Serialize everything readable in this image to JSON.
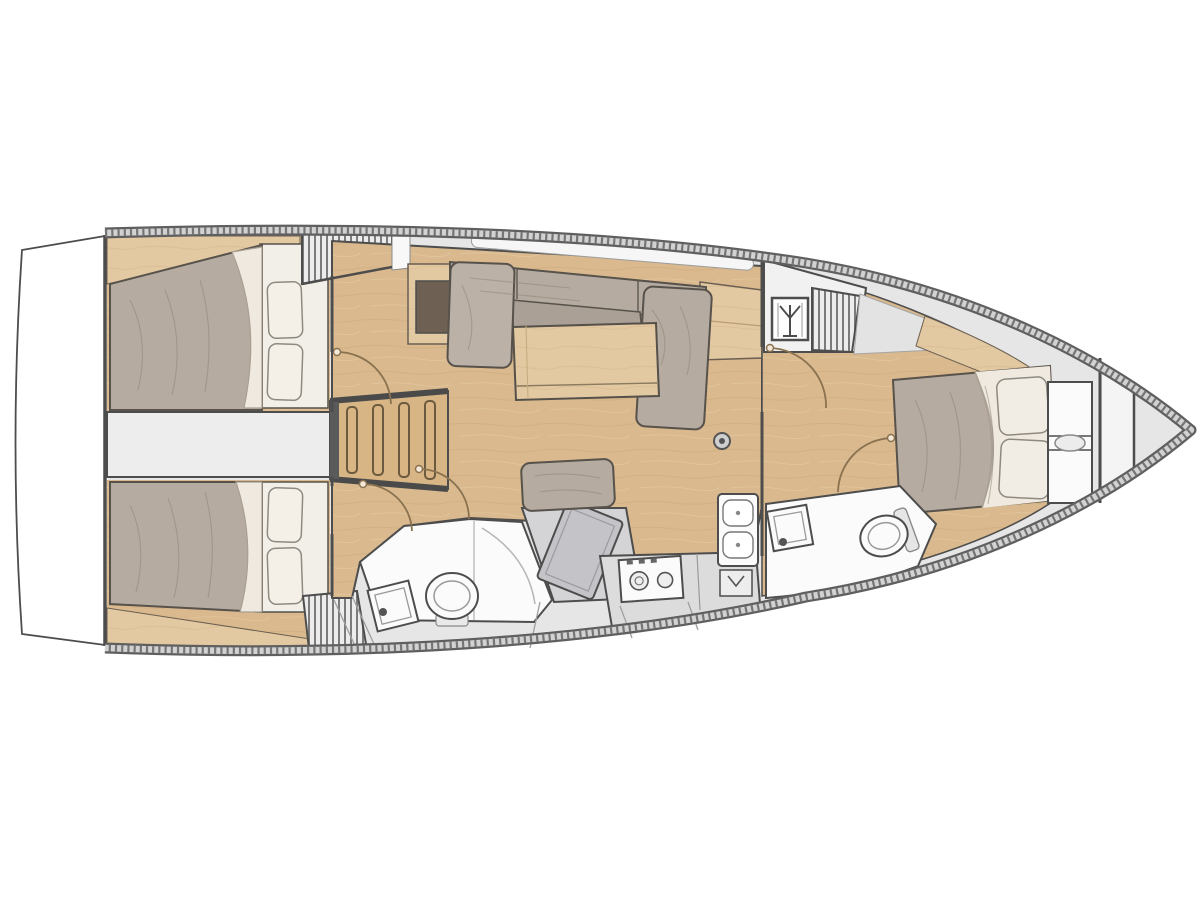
{
  "diagram": {
    "type": "sailing-yacht-interior-floor-plan",
    "orientation": {
      "bow": "right",
      "stern": "left"
    },
    "rooms": [
      {
        "id": "swim-platform",
        "name": "transom swim platform"
      },
      {
        "id": "aft-cabin-starboard",
        "name": "aft double cabin starboard",
        "furniture": [
          "double-berth",
          "two-pillows",
          "shelf",
          "hanging-locker"
        ]
      },
      {
        "id": "engine-corridor",
        "name": "corridor between aft cabins"
      },
      {
        "id": "companionway",
        "name": "companionway ladder",
        "steps": 4
      },
      {
        "id": "aft-cabin-port",
        "name": "aft double cabin port",
        "furniture": [
          "double-berth",
          "two-pillows",
          "shelf",
          "hanging-locker"
        ]
      },
      {
        "id": "salon",
        "name": "salon",
        "furniture": [
          "l-shaped-settee",
          "folding-table",
          "tv-cabinet",
          "sideboard"
        ]
      },
      {
        "id": "nav-station",
        "name": "navigation station",
        "furniture": [
          "seat-cushion",
          "chart-table"
        ]
      },
      {
        "id": "aft-heads",
        "name": "aft heads with shower",
        "furniture": [
          "toilet",
          "washbasin",
          "shower-pan"
        ]
      },
      {
        "id": "galley",
        "name": "linear galley port side",
        "furniture": [
          "two-burner-stove",
          "double-sink",
          "counter"
        ]
      },
      {
        "id": "forward-heads",
        "name": "forward heads",
        "furniture": [
          "toilet",
          "washbasin"
        ]
      },
      {
        "id": "forward-cabin",
        "name": "forward owner cabin",
        "furniture": [
          "island-double-berth",
          "two-pillows",
          "bow-shelving"
        ]
      },
      {
        "id": "bow-locker",
        "name": "bow anchor locker"
      }
    ],
    "icons": [
      {
        "id": "mast-step-icon",
        "meaning": "mast position symbol"
      }
    ],
    "door_arcs": 5,
    "colors": {
      "background": "#ffffff",
      "hull_band_dark": "#5f5f5f",
      "hull_band_light": "#d2d2d2",
      "hull_hatch": "#757575",
      "deck_gray": "#e6e6e6",
      "wall": "#4d4d4d",
      "wood_floor": "#d9b98d",
      "wood_trim": "#e3c9a1",
      "upholstery": "#b5aba0",
      "bedding": "#efe9df",
      "fixture_white": "#fbfbfb",
      "nav_gray": "#c4c4c8",
      "counter_gray": "#dcdcdc",
      "door_arc": "#8a7250",
      "tv_panel": "#6e6053"
    }
  }
}
